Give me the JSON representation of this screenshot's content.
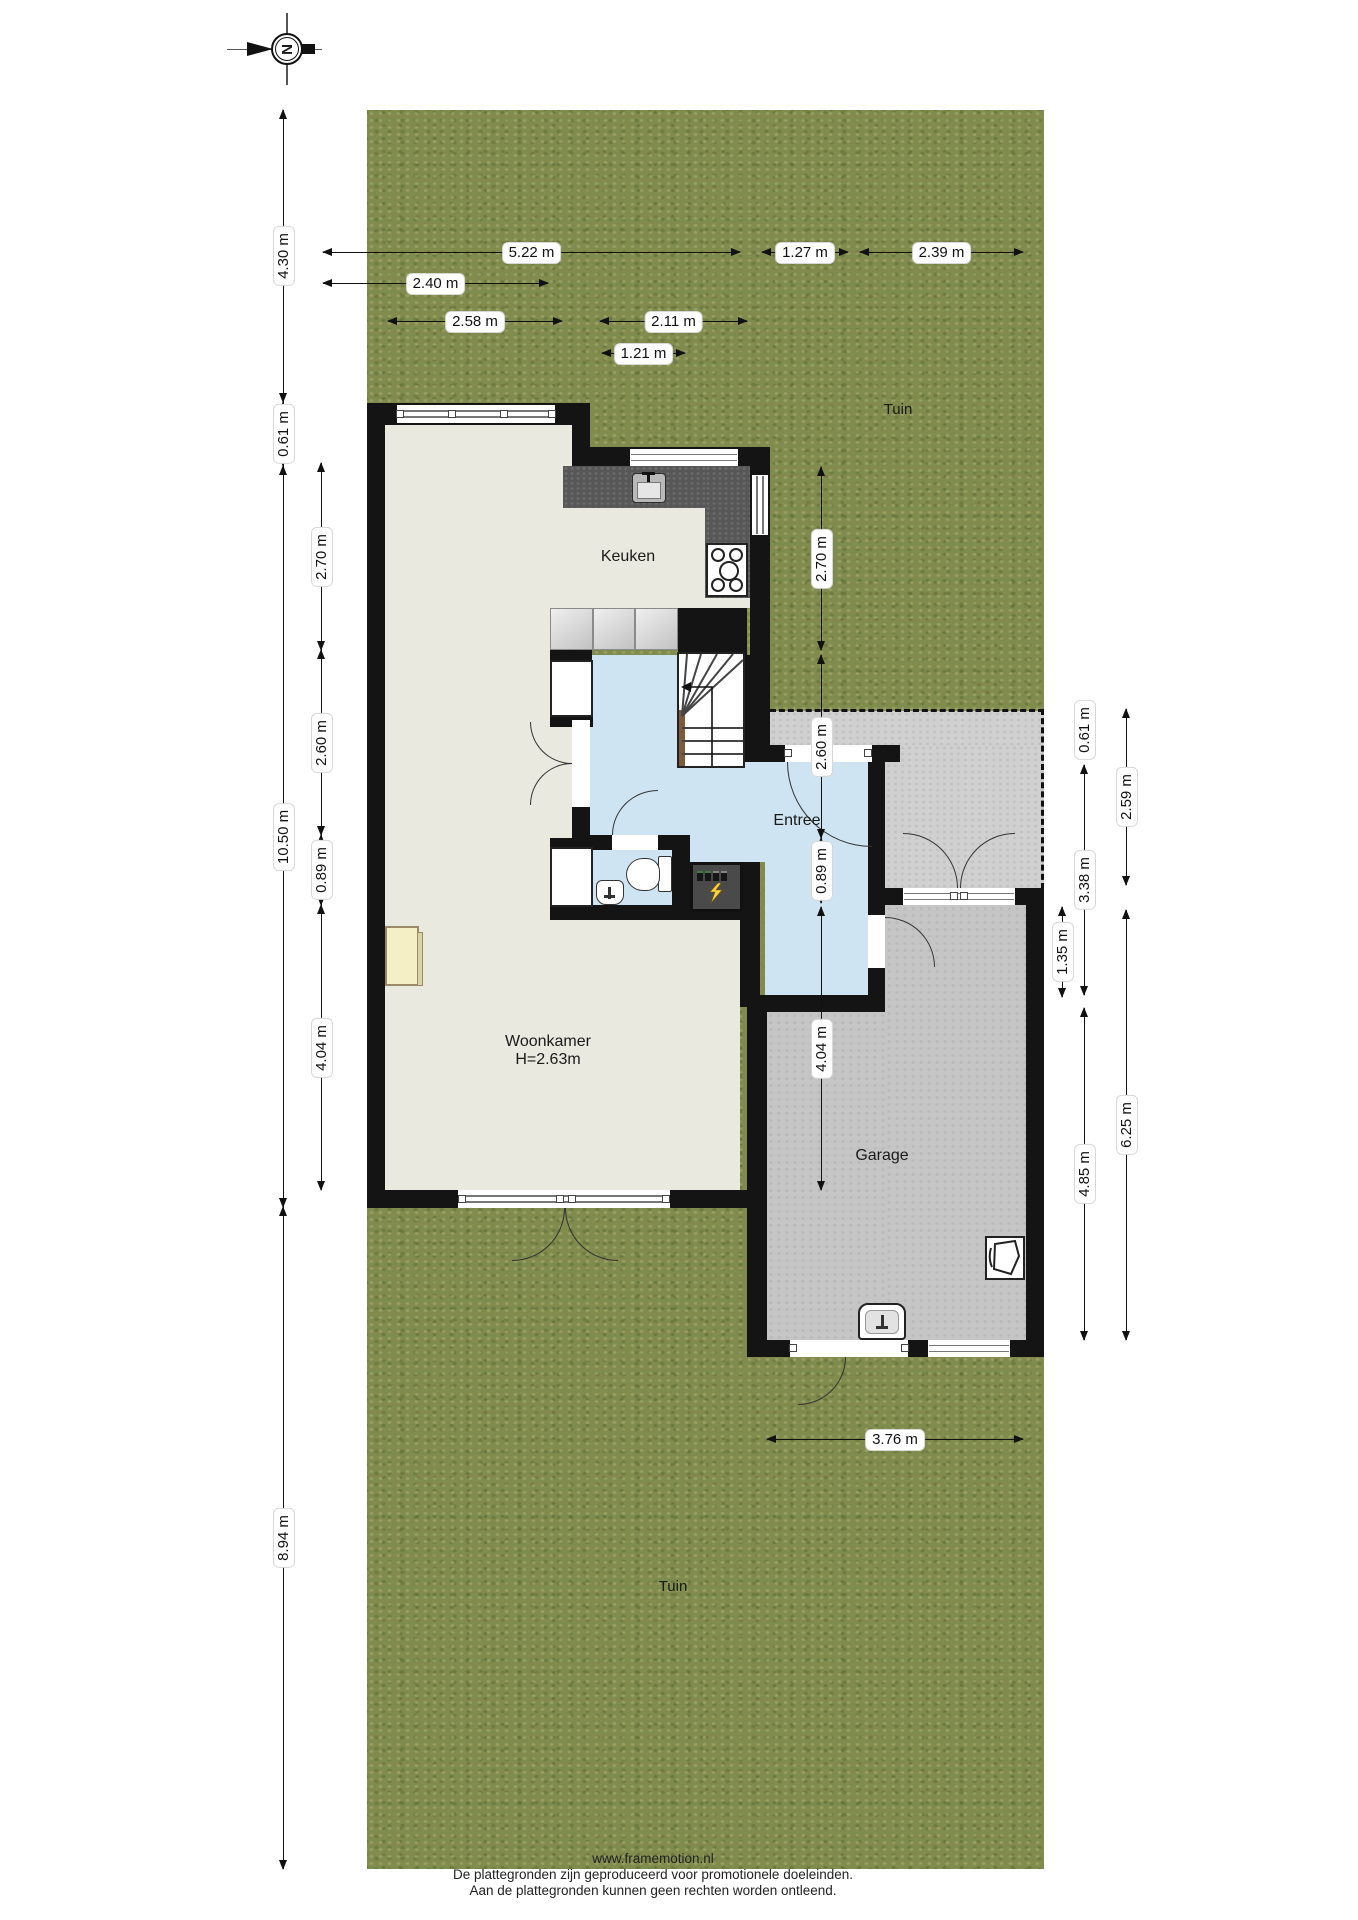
{
  "title": "floorplan",
  "compass": {
    "letter": "N"
  },
  "garden": {
    "label_top": "Tuin",
    "label_bottom": "Tuin"
  },
  "rooms": {
    "kitchen": {
      "label": "Keuken"
    },
    "entry": {
      "label": "Entree"
    },
    "living": {
      "label": "Woonkamer",
      "height_note": "H=2.63m"
    },
    "garage": {
      "label": "Garage"
    }
  },
  "colors": {
    "grass": "#7f8c4e",
    "floor_cream": "#e9e9df",
    "floor_blue": "#cfe4f2",
    "floor_garage": "#c5c5c5",
    "driveway": "#d0d0d0",
    "wall": "#141414",
    "counter": "#575757",
    "meter_lightning": "#ffd23f"
  },
  "dimensions": [
    {
      "label": "5.22 m",
      "o": "h",
      "x": 323,
      "y": 253,
      "len": 417
    },
    {
      "label": "1.27 m",
      "o": "h",
      "x": 762,
      "y": 253,
      "len": 86
    },
    {
      "label": "2.39 m",
      "o": "h",
      "x": 860,
      "y": 253,
      "len": 163
    },
    {
      "label": "2.40 m",
      "o": "h",
      "x": 323,
      "y": 284,
      "len": 225
    },
    {
      "label": "2.58 m",
      "o": "h",
      "x": 388,
      "y": 322,
      "len": 174
    },
    {
      "label": "2.11 m",
      "o": "h",
      "x": 600,
      "y": 322,
      "len": 147
    },
    {
      "label": "1.21 m",
      "o": "h",
      "x": 602,
      "y": 354,
      "len": 83
    },
    {
      "label": "3.76 m",
      "o": "h",
      "x": 767,
      "y": 1440,
      "len": 256
    },
    {
      "label": "4.30 m",
      "o": "v",
      "x": 284,
      "y": 110,
      "len": 292
    },
    {
      "label": "0.61 m",
      "o": "v",
      "x": 284,
      "y": 402,
      "len": 64
    },
    {
      "label": "10.50 m",
      "o": "v",
      "x": 284,
      "y": 466,
      "len": 741
    },
    {
      "label": "8.94 m",
      "o": "v",
      "x": 284,
      "y": 1207,
      "len": 662
    },
    {
      "label": "2.70 m",
      "o": "v",
      "x": 322,
      "y": 463,
      "len": 187
    },
    {
      "label": "2.60 m",
      "o": "v",
      "x": 322,
      "y": 650,
      "len": 185
    },
    {
      "label": "0.89 m",
      "o": "v",
      "x": 322,
      "y": 835,
      "len": 70
    },
    {
      "label": "4.04 m",
      "o": "v",
      "x": 322,
      "y": 905,
      "len": 285
    },
    {
      "label": "2.70 m",
      "o": "v",
      "x": 822,
      "y": 467,
      "len": 183
    },
    {
      "label": "2.60 m",
      "o": "v",
      "x": 822,
      "y": 655,
      "len": 183
    },
    {
      "label": "0.89 m",
      "o": "v",
      "x": 822,
      "y": 838,
      "len": 65
    },
    {
      "label": "4.04 m",
      "o": "v",
      "x": 822,
      "y": 907,
      "len": 283
    },
    {
      "label": "0.61 m",
      "o": "v",
      "x": 1085,
      "y": 709,
      "len": 41
    },
    {
      "label": "3.38 m",
      "o": "v",
      "x": 1085,
      "y": 765,
      "len": 230
    },
    {
      "label": "4.85 m",
      "o": "v",
      "x": 1085,
      "y": 1008,
      "len": 332
    },
    {
      "label": "1.35 m",
      "o": "v",
      "x": 1063,
      "y": 907,
      "len": 90
    },
    {
      "label": "2.59 m",
      "o": "v",
      "x": 1127,
      "y": 709,
      "len": 176
    },
    {
      "label": "6.25 m",
      "o": "v",
      "x": 1127,
      "y": 910,
      "len": 430
    }
  ],
  "footer": {
    "line1": "www.framemotion.nl",
    "line2": "De plattegronden zijn geproduceerd voor promotionele doeleinden.",
    "line3": "Aan de plattegronden kunnen geen rechten worden ontleend."
  }
}
